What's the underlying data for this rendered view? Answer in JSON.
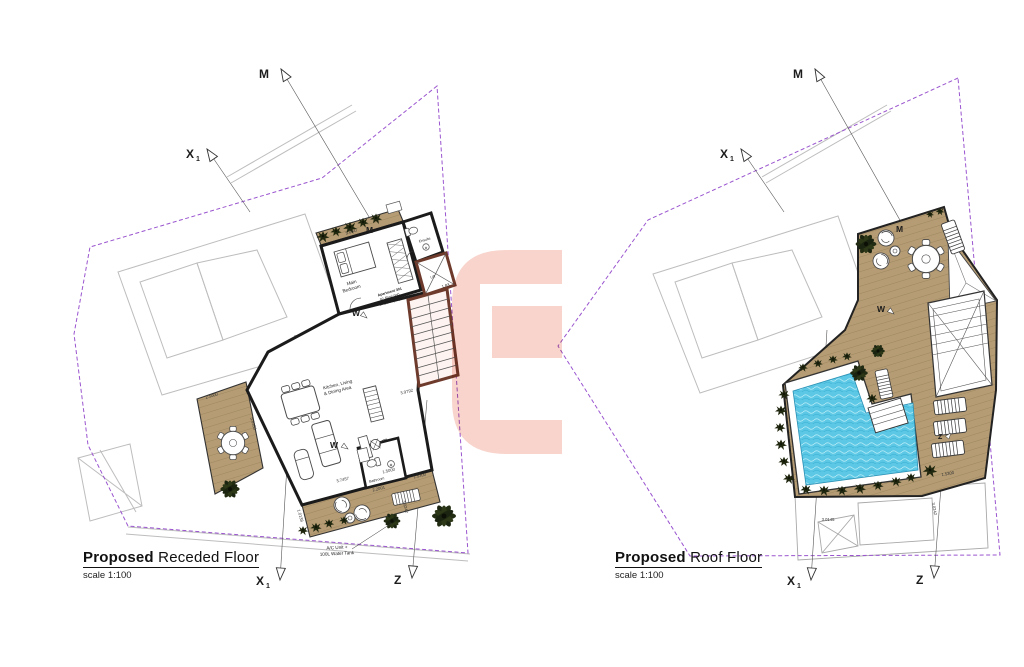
{
  "sheet": {
    "background": "#ffffff"
  },
  "colors": {
    "boundary": "#9a55cf",
    "wall": "#1b1b1b",
    "core_wall": "#6e3a2b",
    "deck": "#b59c74",
    "pool": "#5cc8e5",
    "plant": "#20270f",
    "watermark": "#f8d2c9",
    "neighbor": "#bdbdbd"
  },
  "markers": {
    "m": "M",
    "x": "X",
    "x_sub": "1",
    "z": "Z",
    "w": "W"
  },
  "plans": {
    "left": {
      "title_bold": "Proposed",
      "title_rest": "Receded Floor",
      "scale": "scale 1:100",
      "labels": {
        "bedroom_1": "Main",
        "bedroom_2": "Bedroom",
        "ensuite": "Ensuite",
        "kitchen_1": "Kitchen, Living",
        "kitchen_2": "& Dining Area",
        "bathroom": "Bathroom",
        "lift": "Lift",
        "apt_1": "Apartment 301",
        "apt_2": "92.45m² (int)",
        "apt_3": "84.21m² (ext)",
        "ac_1": "A/C Unit +",
        "ac_2": "100L Water Tank"
      },
      "dims": [
        "3.6447",
        "2.5000",
        "5.6353",
        "3.7457",
        "1.5000",
        "1.5300",
        "2.2001",
        "3.0242",
        "3.9792",
        "1.83",
        "1.0138"
      ]
    },
    "right": {
      "title_bold": "Proposed",
      "title_rest": "Roof Floor",
      "scale": "scale 1:100",
      "dims": [
        "3.0145",
        "3.0242",
        "1.5300"
      ]
    }
  }
}
